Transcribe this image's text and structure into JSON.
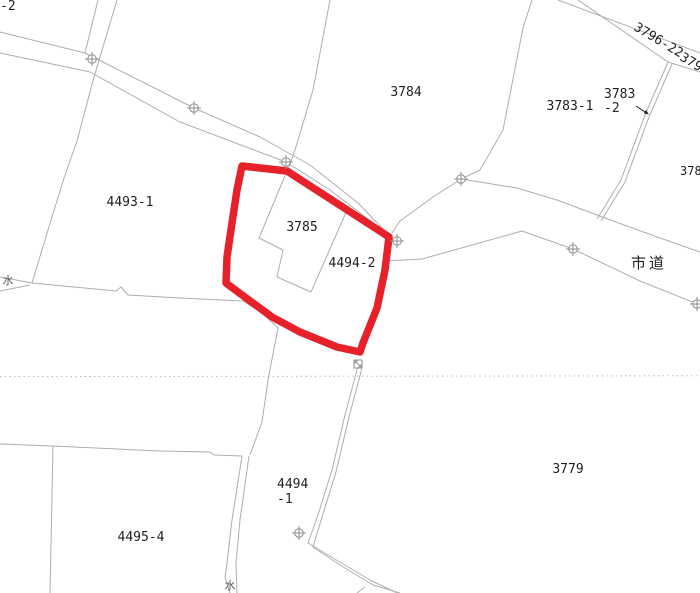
{
  "map_type": "cadastral-parcel-map",
  "colors": {
    "highlight_red": "#e62129",
    "boundary_gray": "#aeaeae",
    "marker_gray": "#8f8f8f",
    "text_dark": "#1f1f1f",
    "background": "#ffffff",
    "dotted_gray": "#a3a3a3"
  },
  "symbols": {
    "boundary_marker": "circle-cross",
    "survey_point": "hatched-square",
    "water_mark": "水"
  },
  "highlight": {
    "outlined_parcels": "3785 / 4494-2"
  },
  "labels": {
    "cut_left": {
      "text": "-2"
    },
    "p4493_1": {
      "text": "4493-1"
    },
    "p3785": {
      "text": "3785"
    },
    "p4494_2": {
      "text": "4494-2"
    },
    "p3784": {
      "text": "3784"
    },
    "p3783_1": {
      "text": "3783-1"
    },
    "p3783_2_l1": {
      "text": "3783"
    },
    "p3783_2_l2": {
      "text": "-2"
    },
    "road_name": {
      "text": "市道"
    },
    "p3779": {
      "text": "3779"
    },
    "p4495_4": {
      "text": "4495-4"
    },
    "p4494_1_l1": {
      "text": "4494"
    },
    "p4494_1_l2": {
      "text": "-1"
    },
    "r3796_22": {
      "text": "3796-22"
    },
    "r3796": {
      "text": "3796"
    },
    "p378_cut": {
      "text": "378"
    },
    "water_nw": {
      "text": "水"
    },
    "water_s": {
      "text": "水"
    }
  }
}
